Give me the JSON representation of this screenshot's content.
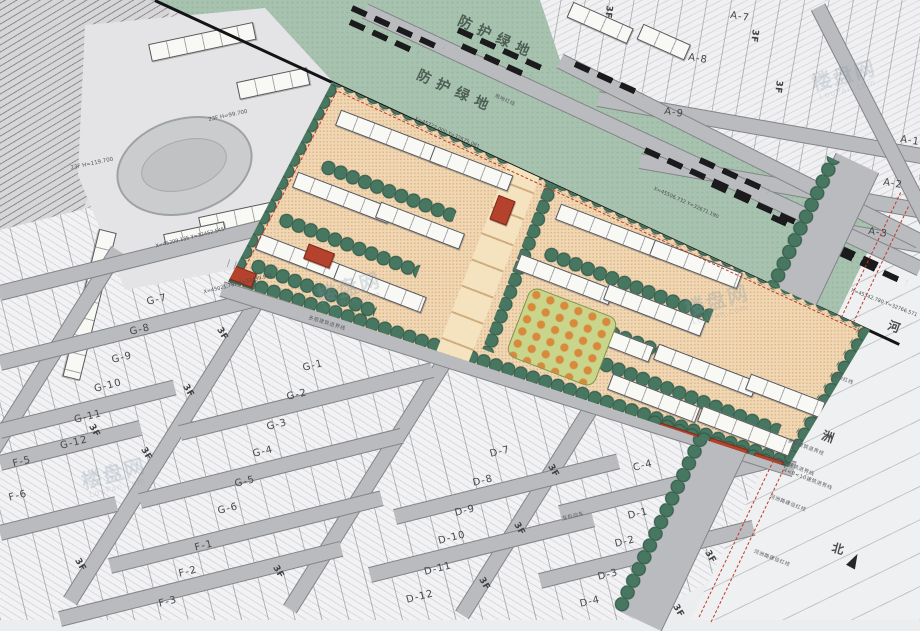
{
  "greenbelt": {
    "label": "防护绿地",
    "positions": [
      {
        "x": 497,
        "y": 37,
        "r": 24.5
      },
      {
        "x": 456,
        "y": 91,
        "r": 24.5
      }
    ]
  },
  "plots": [
    {
      "label": "A-7",
      "x": 740,
      "y": 17,
      "r": 9
    },
    {
      "label": "A-8",
      "x": 698,
      "y": 59,
      "r": 9
    },
    {
      "label": "A-9",
      "x": 674,
      "y": 113,
      "r": 9
    },
    {
      "label": "A-1",
      "x": 910,
      "y": 141,
      "r": 9
    },
    {
      "label": "A-2",
      "x": 893,
      "y": 184,
      "r": 9
    },
    {
      "label": "A-3",
      "x": 878,
      "y": 233,
      "r": 9
    },
    {
      "label": "G-7",
      "x": 157,
      "y": 300,
      "r": -14
    },
    {
      "label": "G-8",
      "x": 140,
      "y": 330,
      "r": -14
    },
    {
      "label": "G-9",
      "x": 122,
      "y": 358,
      "r": -14
    },
    {
      "label": "G-10",
      "x": 108,
      "y": 386,
      "r": -14
    },
    {
      "label": "G-11",
      "x": 88,
      "y": 417,
      "r": -14
    },
    {
      "label": "G-12",
      "x": 74,
      "y": 443,
      "r": -14
    },
    {
      "label": "F-5",
      "x": 22,
      "y": 462,
      "r": -14
    },
    {
      "label": "F-6",
      "x": 18,
      "y": 496,
      "r": -14
    },
    {
      "label": "G-1",
      "x": 313,
      "y": 366,
      "r": -14
    },
    {
      "label": "G-2",
      "x": 297,
      "y": 395,
      "r": -14
    },
    {
      "label": "G-3",
      "x": 277,
      "y": 425,
      "r": -14
    },
    {
      "label": "G-4",
      "x": 263,
      "y": 452,
      "r": -14
    },
    {
      "label": "G-5",
      "x": 245,
      "y": 482,
      "r": -14
    },
    {
      "label": "G-6",
      "x": 228,
      "y": 509,
      "r": -14
    },
    {
      "label": "F-1",
      "x": 204,
      "y": 546,
      "r": -14
    },
    {
      "label": "F-2",
      "x": 188,
      "y": 572,
      "r": -14
    },
    {
      "label": "F-3",
      "x": 168,
      "y": 602,
      "r": -14
    },
    {
      "label": "D-7",
      "x": 500,
      "y": 452,
      "r": -14
    },
    {
      "label": "D-8",
      "x": 483,
      "y": 481,
      "r": -14
    },
    {
      "label": "D-9",
      "x": 465,
      "y": 511,
      "r": -14
    },
    {
      "label": "D-10",
      "x": 452,
      "y": 538,
      "r": -14
    },
    {
      "label": "D-11",
      "x": 438,
      "y": 569,
      "r": -14
    },
    {
      "label": "D-12",
      "x": 420,
      "y": 597,
      "r": -14
    },
    {
      "label": "C-4",
      "x": 643,
      "y": 466,
      "r": -14
    },
    {
      "label": "D-1",
      "x": 638,
      "y": 514,
      "r": -14
    },
    {
      "label": "D-2",
      "x": 625,
      "y": 542,
      "r": -14
    },
    {
      "label": "D-3",
      "x": 608,
      "y": 575,
      "r": -14
    },
    {
      "label": "D-4",
      "x": 590,
      "y": 602,
      "r": -14
    }
  ],
  "floor_marker": {
    "label": "3F",
    "positions": [
      [
        222,
        334,
        59
      ],
      [
        188,
        391,
        59
      ],
      [
        146,
        454,
        59
      ],
      [
        94,
        431,
        59
      ],
      [
        80,
        565,
        59
      ],
      [
        278,
        572,
        59
      ],
      [
        553,
        471,
        59
      ],
      [
        519,
        529,
        59
      ],
      [
        484,
        584,
        59
      ],
      [
        710,
        557,
        59
      ],
      [
        678,
        611,
        59
      ],
      [
        754,
        36,
        97
      ],
      [
        778,
        87,
        97
      ],
      [
        608,
        12,
        97
      ]
    ]
  },
  "river": {
    "char1": "河",
    "char2": "洲",
    "north": "北"
  },
  "notes": [
    {
      "t": "用地红线",
      "x": 505,
      "y": 100,
      "r": 24
    },
    {
      "t": "用地红线",
      "x": 843,
      "y": 379,
      "r": 21
    },
    {
      "t": "多层建筑退界线",
      "x": 327,
      "y": 323,
      "r": 17
    },
    {
      "t": "多层建筑退界线",
      "x": 806,
      "y": 447,
      "r": 21
    },
    {
      "t": "4<B<50建筑退界线",
      "x": 790,
      "y": 465,
      "r": 21
    },
    {
      "t": "4<B<10建筑退界线",
      "x": 808,
      "y": 479,
      "r": 21
    },
    {
      "t": "河洲路建设红线",
      "x": 788,
      "y": 503,
      "r": 21
    },
    {
      "t": "河洲路建设红线",
      "x": 772,
      "y": 558,
      "r": 21
    },
    {
      "t": "非机动车",
      "x": 573,
      "y": 516,
      "r": -14
    }
  ],
  "coordinates": [
    {
      "t": "X=45722.000  Y=32675.081",
      "x": 447,
      "y": 133,
      "r": 24
    },
    {
      "t": "X=45506.732  Y=32671.190",
      "x": 686,
      "y": 203,
      "r": 24
    },
    {
      "t": "X=45342.780  Y=32766.571",
      "x": 884,
      "y": 303,
      "r": 21
    },
    {
      "t": "X=45209.135  Y=32452.545",
      "x": 190,
      "y": 238,
      "r": -14
    },
    {
      "t": "X=45021.787  Y=32439.941",
      "x": 238,
      "y": 284,
      "r": -14
    }
  ],
  "buildings": [
    {
      "t": "23F  H=119.700",
      "x": 92,
      "y": 164,
      "r": -12
    },
    {
      "t": "23F  H=99.700",
      "x": 228,
      "y": 116,
      "r": -12
    }
  ],
  "watermark": {
    "cn": "楼盘网",
    "en": "LouPan.com",
    "positions": [
      {
        "x": 350,
        "y": 292,
        "r": -15
      },
      {
        "x": 718,
        "y": 305,
        "r": -15
      },
      {
        "x": 115,
        "y": 478,
        "r": -15
      },
      {
        "x": 845,
        "y": 80,
        "r": -15
      }
    ]
  },
  "colors": {
    "greenbelt": "#a7c2af",
    "tree": "#3f6b57",
    "compound_ground": "#f0d7b4",
    "building": "#f8f8f5",
    "accent_red": "#b5422c",
    "road": "#babbbe",
    "boundary_red": "#c0392b",
    "field": "#f2f2f4"
  }
}
